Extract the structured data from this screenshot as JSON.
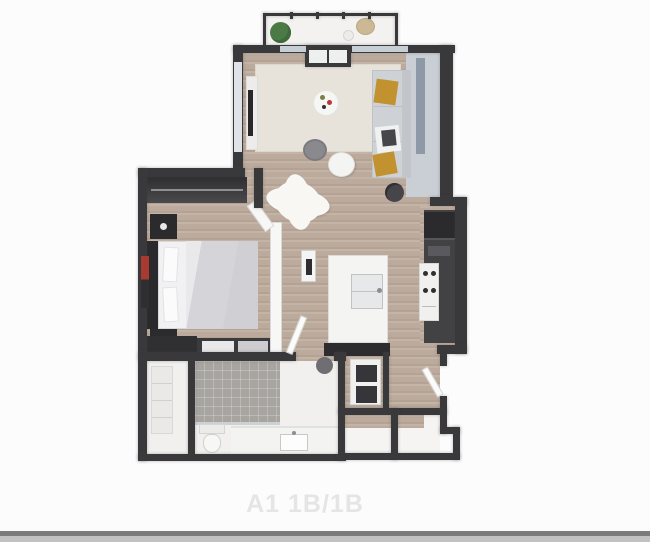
{
  "image": {
    "width": 650,
    "height": 542,
    "background": "#fcfcfc"
  },
  "floorplan": {
    "label": "A1 1B/1B",
    "style": "3d-rendered-top-down-floor-plan",
    "rooms": [
      {
        "name": "balcony",
        "items": [
          "potted-plant",
          "lounge-chair",
          "side-table"
        ]
      },
      {
        "name": "living-room",
        "items": [
          "sofa",
          "mustard-pillows",
          "coffee-table",
          "round-rug",
          "area-rug",
          "decor-table",
          "media-console",
          "tv",
          "floor-plant"
        ]
      },
      {
        "name": "bedroom",
        "items": [
          "bed",
          "headboard",
          "nightstand",
          "nightstand",
          "wardrobe-closet",
          "dresser",
          "wall-artwork",
          "shag-rug",
          "wall-tv"
        ]
      },
      {
        "name": "kitchen",
        "items": [
          "refrigerator",
          "range",
          "cabinets",
          "island-with-sink",
          "breakfast-counter",
          "stool"
        ]
      },
      {
        "name": "laundry-closet",
        "items": [
          "stacked-washer-dryer"
        ]
      },
      {
        "name": "bathroom",
        "items": [
          "tiled-shower",
          "toilet",
          "vanity-sink",
          "linen-closet"
        ]
      },
      {
        "name": "entry",
        "items": [
          "entry-door",
          "coat-closet",
          "storage-closet"
        ]
      }
    ],
    "colors": {
      "walls": "#39393b",
      "wood_floor": "#bcab9c",
      "area_rug": "#e8e3da",
      "sofa": "#ced2d6",
      "accent_pillow": "#c1922f",
      "shower_tile": "#a8a5a1",
      "balcony_floor": "#f3f2f0",
      "label_text": "#e5e5e5",
      "divider_bar": "#7c7c7c"
    }
  }
}
